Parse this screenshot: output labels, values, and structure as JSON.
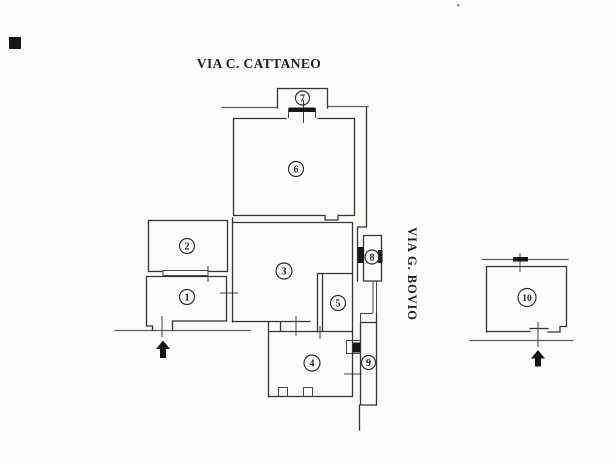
{
  "plan": {
    "streets": {
      "top_label": "VIA C. CATTANEO",
      "right_label": "VIA G. BOVIO"
    },
    "rooms": [
      {
        "label": "1"
      },
      {
        "label": "2"
      },
      {
        "label": "3"
      },
      {
        "label": "4"
      },
      {
        "label": "5"
      },
      {
        "label": "6"
      },
      {
        "label": "7"
      },
      {
        "label": "8"
      },
      {
        "label": "9"
      },
      {
        "label": "10"
      }
    ],
    "colors": {
      "paper": "#fcfcfa",
      "ink": "#37332f",
      "street_line": "#5f5d5a",
      "door_mark": "#161616",
      "artifact": "#0c0c0c"
    }
  }
}
